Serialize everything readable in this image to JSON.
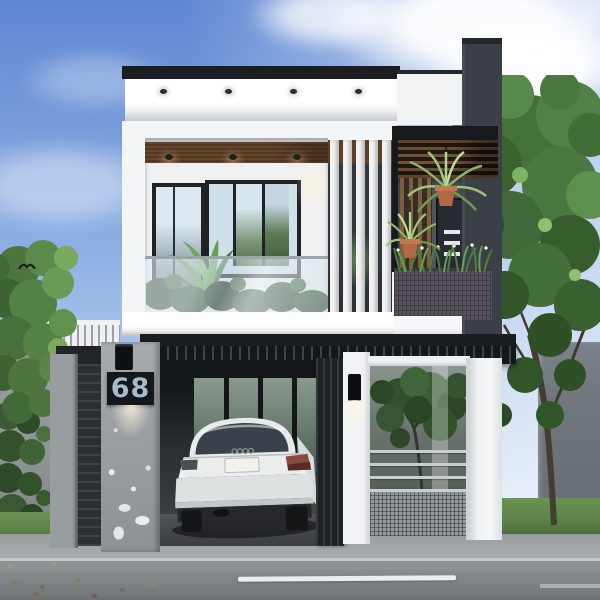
{
  "image": {
    "kind": "3d-architectural-rendering",
    "subject": "modern two-storey white minimalist house, front street elevation, daytime",
    "house_number": "68"
  },
  "house": {
    "number_plaque": {
      "text": "68"
    },
    "floors": 2,
    "visible_features": [
      "flat parapet roof with black capping and recessed soffit downlights",
      "second-floor balcony with glass railing and plants",
      "black aluminium framed windows and door",
      "white vertical sun-shade fins",
      "charcoal brick feature tower",
      "black pergola with timber slats and two hanging spider plants",
      "balcony planter box with shrubs",
      "ground-floor carport with white sedan parked inside",
      "black slatted entry gates",
      "house number plaque with downlight",
      "intercom unit",
      "wall lamp on gate pillar",
      "front fence with glass panel, horizontal rails and mesh base",
      "courtyard tree behind fence"
    ]
  },
  "street": {
    "elements": [
      "paved sidewalk",
      "kerb",
      "asphalt road",
      "white lane marking",
      "lawn strips",
      "small debris"
    ]
  },
  "vegetation": [
    "left street tree",
    "right street tree",
    "ivy on boundary wall",
    "balcony tropical plant",
    "railing shrubs",
    "hanging spider plants",
    "planter shrubs with white flowers"
  ],
  "colors": {
    "sky_top": "#5f87d3",
    "sky_mid": "#8fafe3",
    "sky_low": "#d9e6f5",
    "house_white": "#f3f5f6",
    "roof_black": "#1b1d20",
    "fascia_shadow": "#c6cbd0",
    "soffit_wood": "#7c5434",
    "frame_black": "#1f2326",
    "glass_sky": "#cfe0eb",
    "glass_green": "#54714a",
    "fin_white": "#f1f3f4",
    "tower_charcoal": "#3b4047",
    "pergola_black": "#17191c",
    "slat_wood": "#7e5f3d",
    "pot_terracotta": "#b26844",
    "leaf_light": "#9cc47c",
    "leaf_mid": "#679a50",
    "leaf_dark": "#35552c",
    "planter_gray": "#56515a",
    "concrete": "#9ba0a4",
    "plaque_black": "#14181c",
    "plaque_text": "#a7bac9",
    "gate_black": "#24282c",
    "wall_gray": "#8f9496",
    "building_gray": "#70777d",
    "grass_green": "#5d8248",
    "sidewalk_gray": "#a3a8aa",
    "curb_gray": "#8d9295",
    "road_gray": "#7e8386",
    "lane_white": "#eceeee",
    "car_white": "#e8ebeb",
    "tail_red": "#8a4a40"
  }
}
